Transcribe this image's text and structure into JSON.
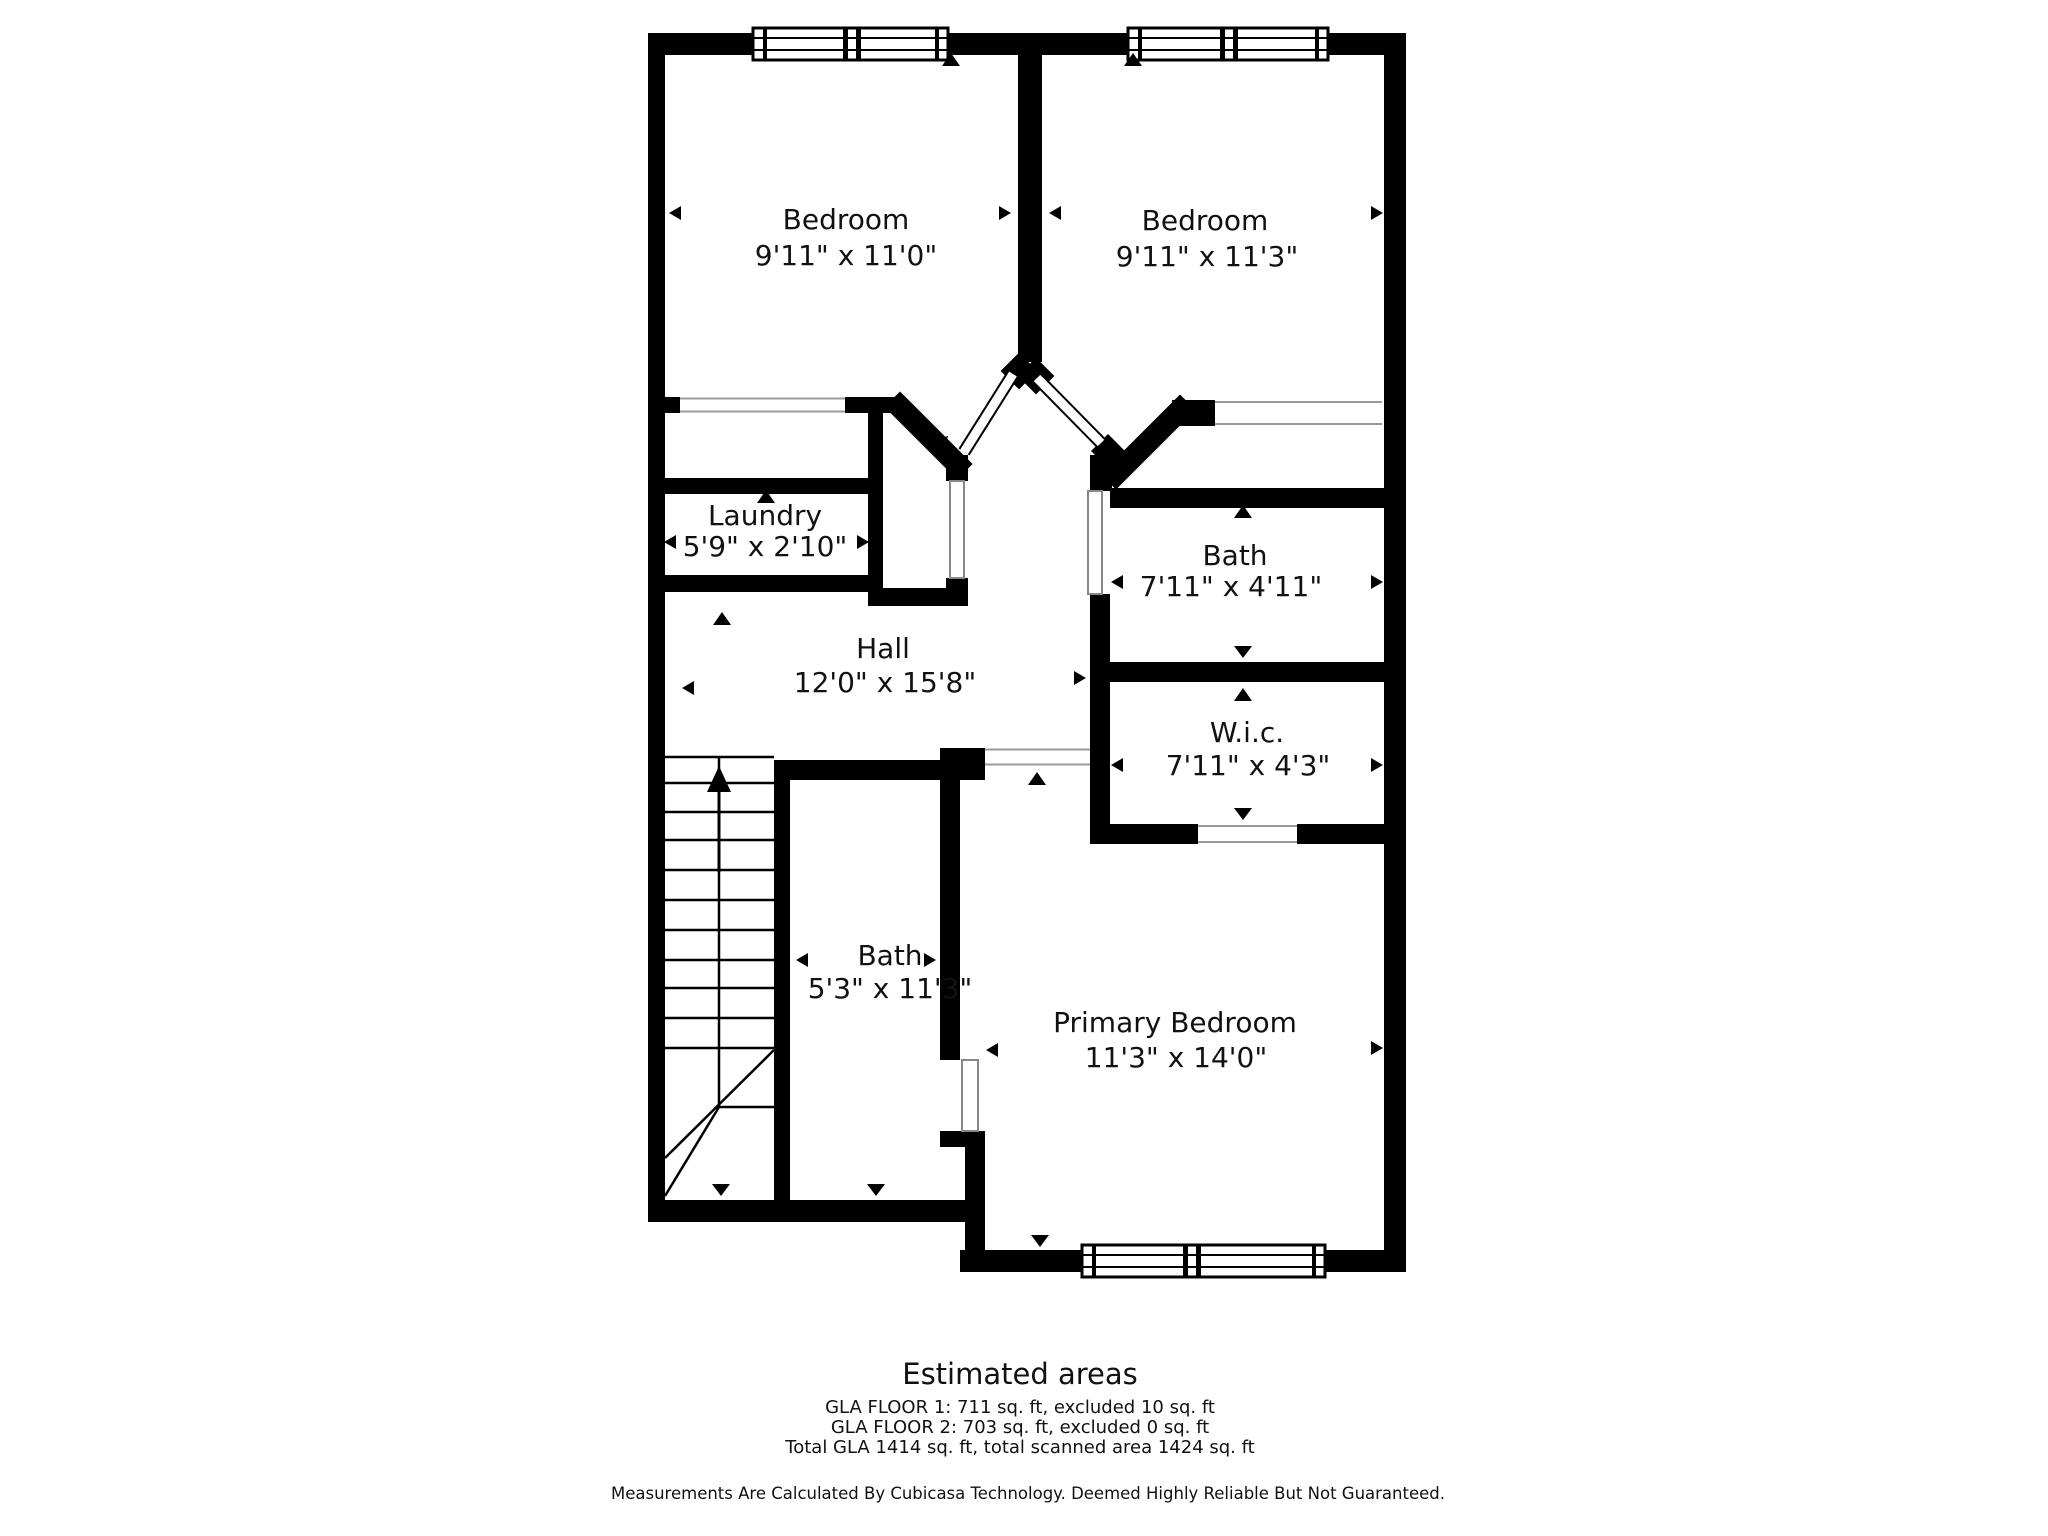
{
  "plan": {
    "rooms": [
      {
        "name": "Bedroom",
        "dims": "9'11\" x 11'0\""
      },
      {
        "name": "Bedroom",
        "dims": "9'11\" x 11'3\""
      },
      {
        "name": "Laundry",
        "dims": "5'9\" x 2'10\""
      },
      {
        "name": "Hall",
        "dims": "12'0\" x 15'8\""
      },
      {
        "name": "Bath",
        "dims": "7'11\" x 4'11\""
      },
      {
        "name": "W.i.c.",
        "dims": "7'11\" x 4'3\""
      },
      {
        "name": "Bath",
        "dims": "5'3\" x 11'3\""
      },
      {
        "name": "Primary Bedroom",
        "dims": "11'3\" x 14'0\""
      }
    ],
    "colors": {
      "wall": "#000000",
      "background": "#ffffff",
      "casing": "#999999"
    }
  },
  "summary": {
    "title": "Estimated areas",
    "floor1": "GLA FLOOR 1: 711 sq. ft, excluded 10 sq. ft",
    "floor2": "GLA FLOOR 2: 703 sq. ft, excluded 0 sq. ft",
    "total": "Total GLA 1414 sq. ft, total scanned area 1424 sq. ft"
  },
  "disclaimer": "Measurements Are Calculated By Cubicasa Technology. Deemed Highly Reliable But Not Guaranteed."
}
